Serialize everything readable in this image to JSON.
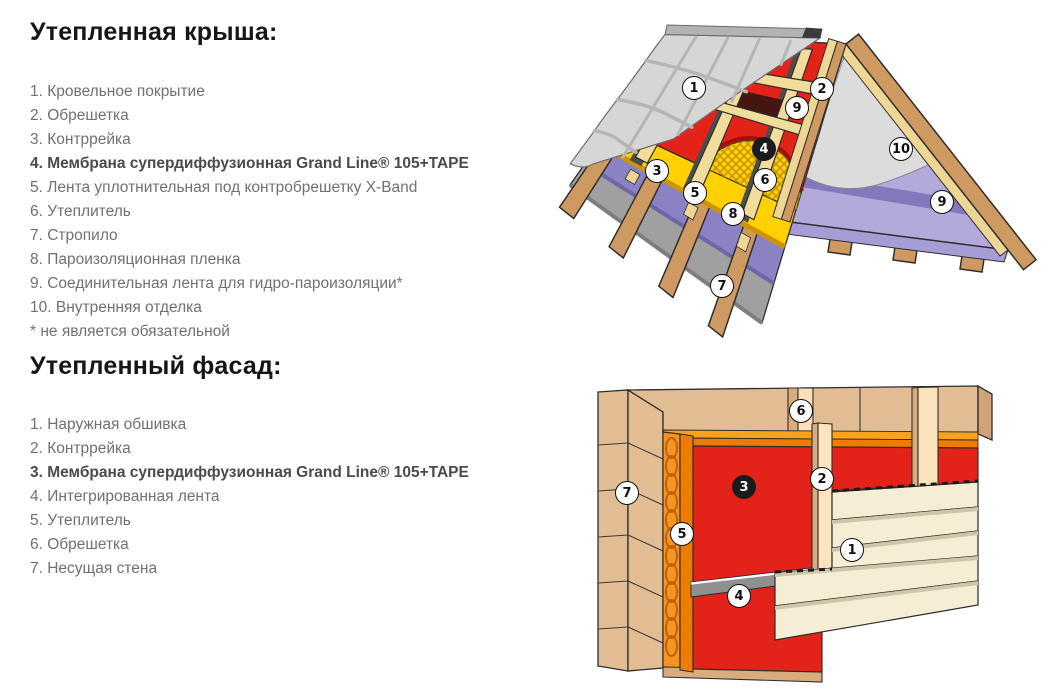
{
  "sections": [
    {
      "heading": "Утепленная крыша:",
      "items": [
        "1. Кровельное покрытие",
        "2. Обрешетка",
        "3. Контррейка",
        "4. Мембрана супердиффузионная Grand Line® 105+TAPE",
        "5. Лента уплотнительная под контробрешетку X-Band",
        "6. Утеплитель",
        "7. Стропило",
        "8. Пароизоляционная пленка",
        "9. Соединительная лента для гидро-пароизоляции*",
        "10. Внутренняя отделка",
        "* не является обязательной"
      ]
    },
    {
      "heading": "Утепленный фасад:",
      "items": [
        "1. Наружная обшивка",
        "2. Контррейка",
        "3. Мембрана супердиффузионная Grand Line® 105+TAPE",
        "4. Интегрированная лента",
        "5. Утеплитель",
        "6. Обрешетка",
        "7. Несущая стена"
      ]
    }
  ],
  "roof_diagram": {
    "badges": [
      {
        "label": "1"
      },
      {
        "label": "2"
      },
      {
        "label": "9"
      },
      {
        "label": "4"
      },
      {
        "label": "3"
      },
      {
        "label": "6"
      },
      {
        "label": "5"
      },
      {
        "label": "8"
      },
      {
        "label": "10"
      },
      {
        "label": "9"
      },
      {
        "label": "7"
      }
    ]
  },
  "facade_diagram": {
    "badges": [
      {
        "label": "6"
      },
      {
        "label": "7"
      },
      {
        "label": "3"
      },
      {
        "label": "2"
      },
      {
        "label": "5"
      },
      {
        "label": "1"
      },
      {
        "label": "4"
      }
    ]
  },
  "colors": {
    "membrane_red": "#e3231a",
    "insulation_yellow": "#ffd103",
    "insulation_orange": "#f7941e",
    "vapor_purple": "#8b82c4",
    "gable_lavender": "#b3aadb",
    "wood_brown": "#cf9a62",
    "batten_tan": "#f0dd9b",
    "wall_tan": "#e2bd94",
    "siding_cream": "#f6eed4",
    "tile_gray": "#d6d6d6",
    "tape_gray": "#909090",
    "text_gray": "#707070",
    "heading_black": "#161616"
  }
}
